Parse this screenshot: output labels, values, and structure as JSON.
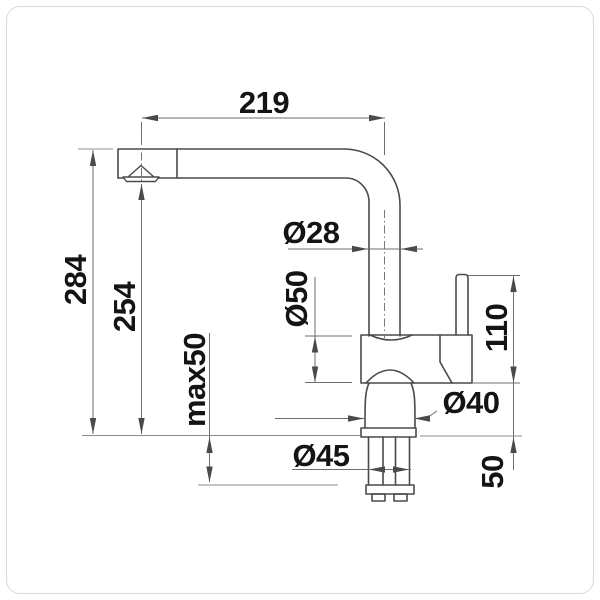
{
  "drawing": {
    "title": "kitchen-faucet-dimension-drawing",
    "view": "side-elevation",
    "dimensions": {
      "spout_reach": "219",
      "total_height": "284",
      "spout_height": "254",
      "max_counter_thickness": "max50",
      "pipe_diameter": "Ø28",
      "body_diameter": "Ø50",
      "handle_height": "110",
      "base_diameter": "Ø40",
      "shank_diameter": "Ø45",
      "shank_length": "50"
    },
    "colors": {
      "background": "#ffffff",
      "object_line": "#4a4a4a",
      "dimension_line": "#6e6e6e",
      "label_text": "#141414",
      "frame_border": "#d9d9d9"
    }
  }
}
